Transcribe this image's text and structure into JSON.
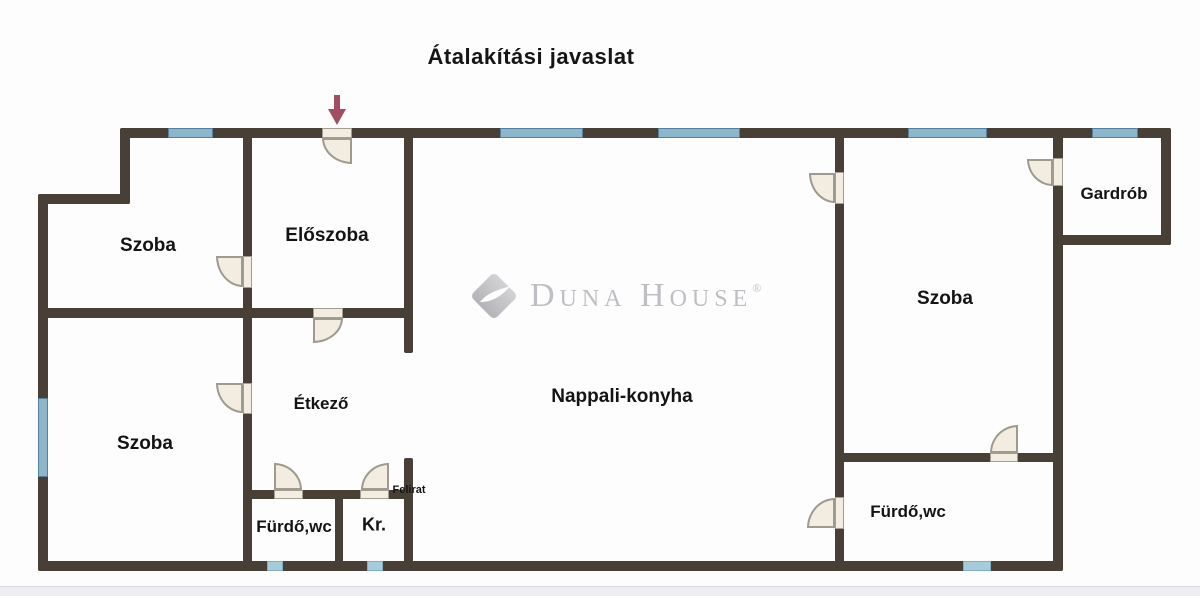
{
  "title": "Átalakítási javaslat",
  "watermark": {
    "brand": "Duna House",
    "display": "Duna House",
    "registered": "®"
  },
  "rooms": {
    "szoba_top_left": "Szoba",
    "eloszoba": "Előszoba",
    "szoba_bottom_left": "Szoba",
    "etkezo": "Étkező",
    "nappali_konyha": "Nappali-konyha",
    "furdo_wc_left": "Fürdő,wc",
    "kamra": "Kr.",
    "felirat": "Felirat",
    "furdo_wc_right": "Fürdő,wc",
    "szoba_right": "Szoba",
    "gardrob": "Gardrób"
  },
  "colors": {
    "wall": "#483f37",
    "window": "#8cb6cb",
    "window_small": "#a7cbd8",
    "door_fill": "#f3ede1",
    "arrow": "#a04f63",
    "watermark_text": "#bfbfc3",
    "label": "#141414"
  }
}
